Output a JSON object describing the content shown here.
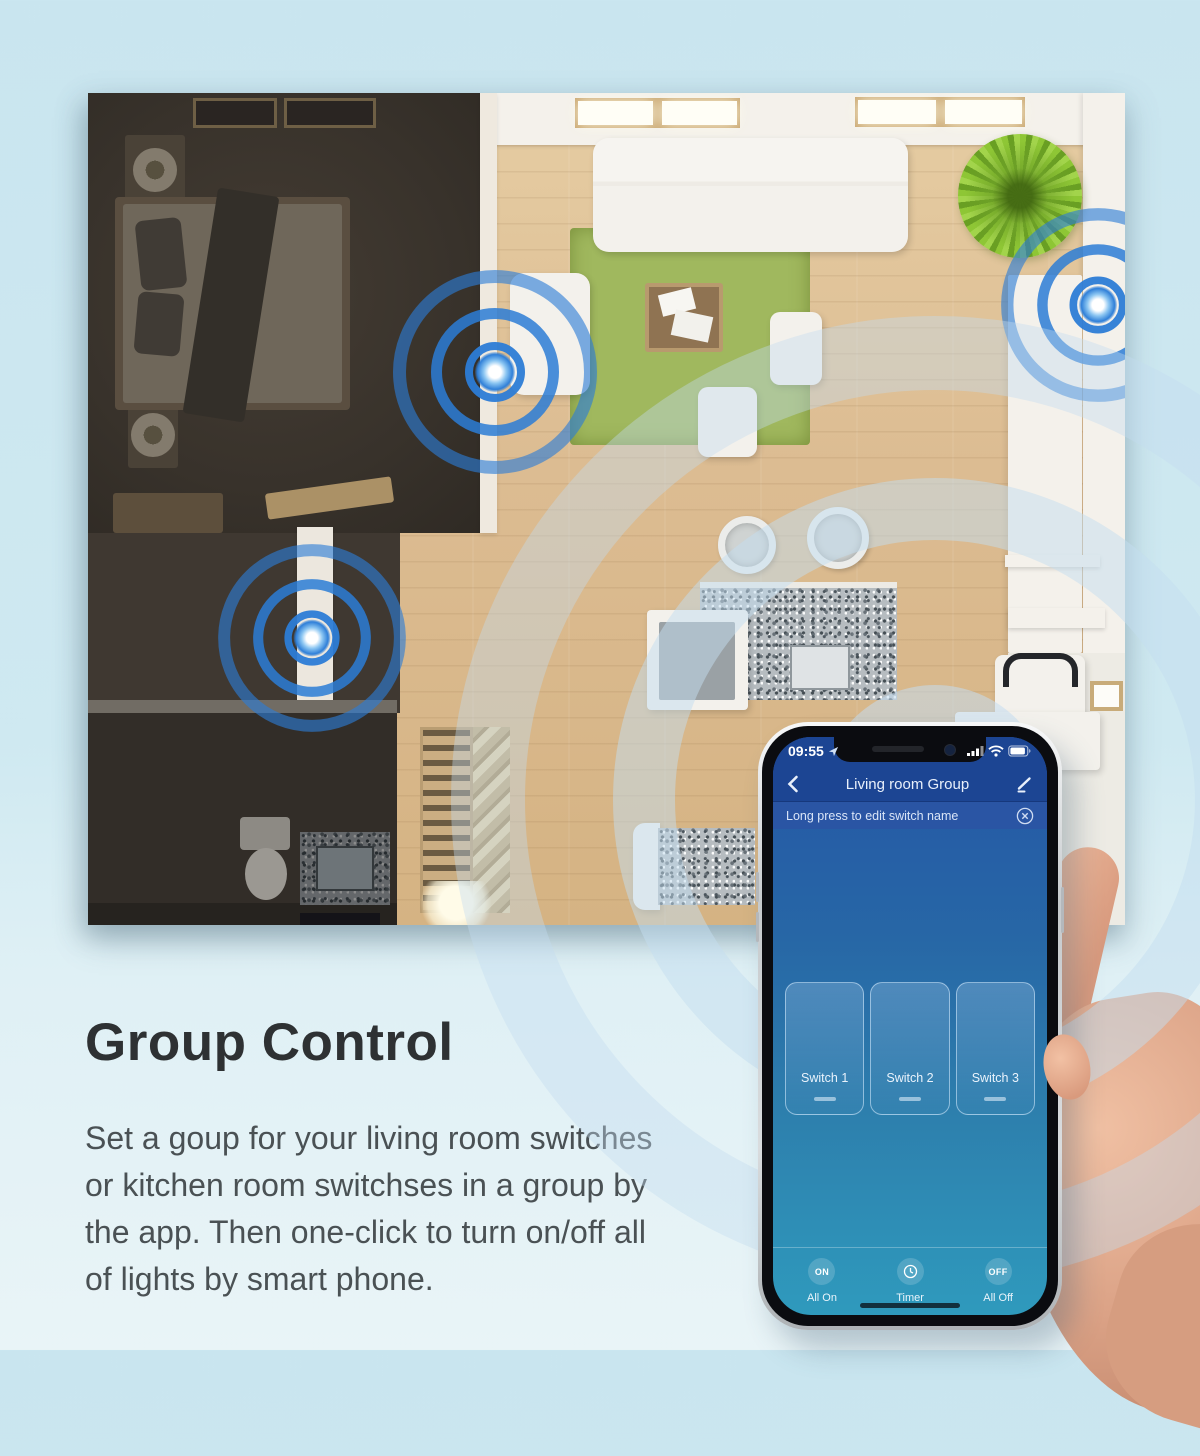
{
  "copy": {
    "heading": "Group Control",
    "lines": [
      "Set a goup for your living room switches",
      "or kitchen room switchses in a group by",
      "the app. Then one-click to turn on/off all",
      "of lights by smart phone."
    ]
  },
  "phone": {
    "status": {
      "time": "09:55"
    },
    "nav": {
      "title": "Living room Group"
    },
    "banner": {
      "text": "Long press to edit switch name"
    },
    "switches": [
      {
        "label": "Switch 1"
      },
      {
        "label": "Switch 2"
      },
      {
        "label": "Switch 3"
      }
    ],
    "actions": {
      "all_on": {
        "button": "ON",
        "label": "All On"
      },
      "timer": {
        "label": "Timer"
      },
      "all_off": {
        "button": "OFF",
        "label": "All Off"
      }
    }
  },
  "colors": {
    "accent_blue": "#2f7fd8",
    "screen_top": "#1c4593",
    "screen_bottom": "#2f9abd",
    "page_background": "#cde8f1",
    "rug_green": "#a0b85e"
  }
}
